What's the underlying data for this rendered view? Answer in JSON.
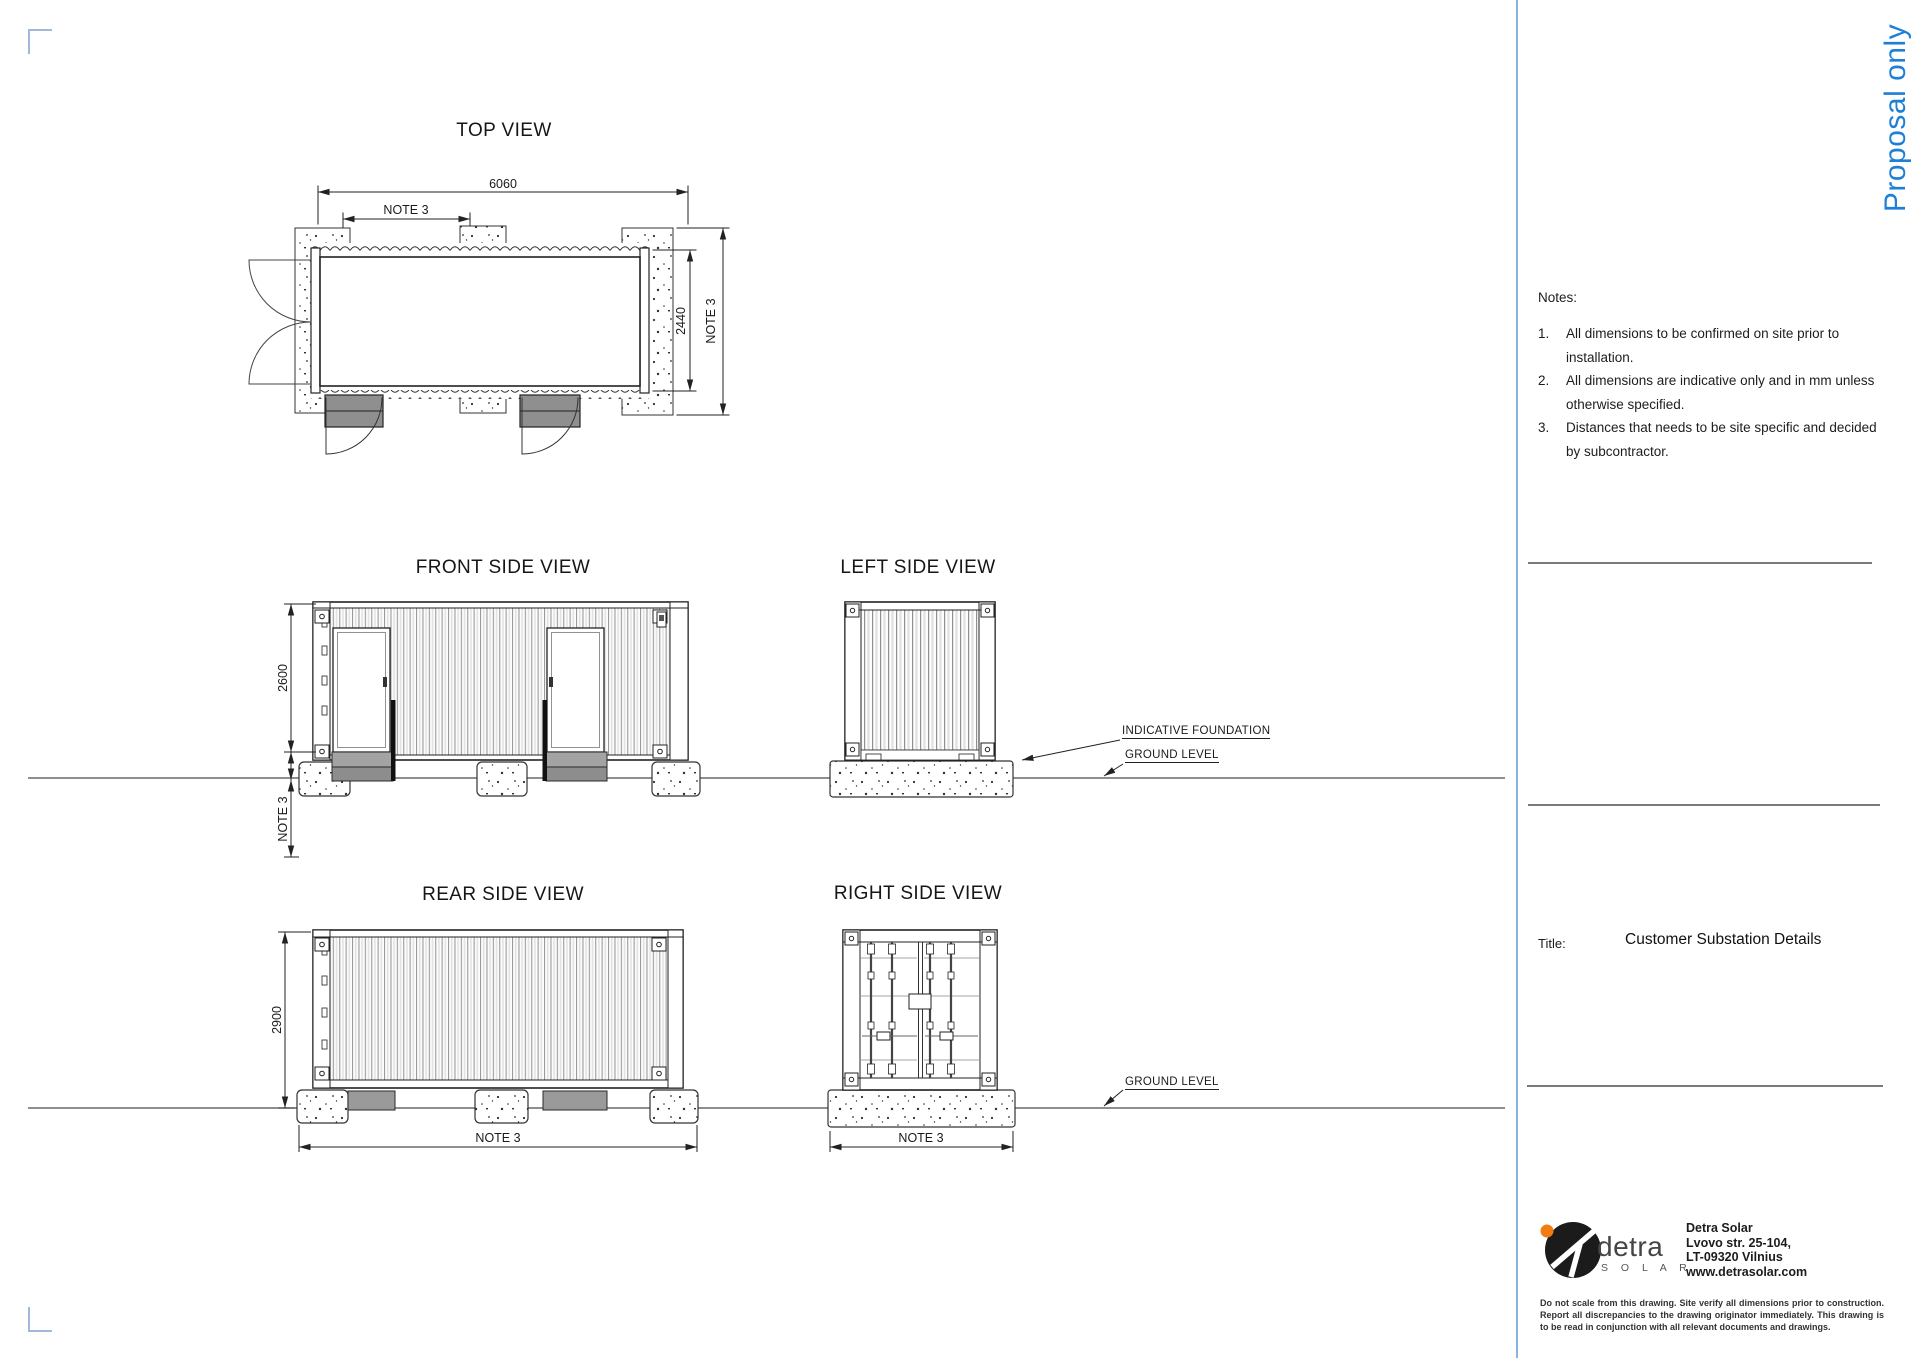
{
  "page": {
    "watermark": "Proposal only",
    "accent_blue": "#1e7fd6",
    "divider_blue": "#8ab4e0"
  },
  "views": {
    "top": {
      "title": "TOP VIEW",
      "dim_width": "6060",
      "dim_note_top": "NOTE 3",
      "dim_depth": "2440",
      "dim_note_right": "NOTE 3"
    },
    "front": {
      "title": "FRONT SIDE VIEW",
      "dim_height": "2600",
      "dim_note_below": "NOTE 3"
    },
    "left": {
      "title": "LEFT SIDE VIEW",
      "label_foundation": "INDICATIVE FOUNDATION",
      "label_ground": "GROUND LEVEL"
    },
    "rear": {
      "title": "REAR SIDE VIEW",
      "dim_height": "2900",
      "dim_note_bottom": "NOTE 3"
    },
    "right": {
      "title": "RIGHT SIDE VIEW",
      "label_ground": "GROUND LEVEL",
      "dim_note_bottom": "NOTE 3"
    }
  },
  "notes": {
    "heading": "Notes:",
    "items": [
      {
        "num": "1.",
        "text": "All dimensions to be confirmed on site prior to installation."
      },
      {
        "num": "2.",
        "text": "All dimensions are indicative only and in mm unless otherwise specified."
      },
      {
        "num": "3.",
        "text": "Distances that needs to be site specific and decided by subcontractor."
      }
    ]
  },
  "title_block": {
    "label": "Title:",
    "value": "Customer Substation Details"
  },
  "company": {
    "logo_word": "detra",
    "logo_sub": "S O L A R",
    "name": "Detra Solar",
    "address_line1": "Lvovo str. 25-104,",
    "address_line2": "LT-09320 Vilnius",
    "website": "www.detrasolar.com",
    "disclaimer": "Do not scale from this drawing. Site verify all dimensions prior to construction. Report all discrepancies to the drawing originator immediately. This drawing is to be read in conjunction with all relevant documents and drawings."
  }
}
